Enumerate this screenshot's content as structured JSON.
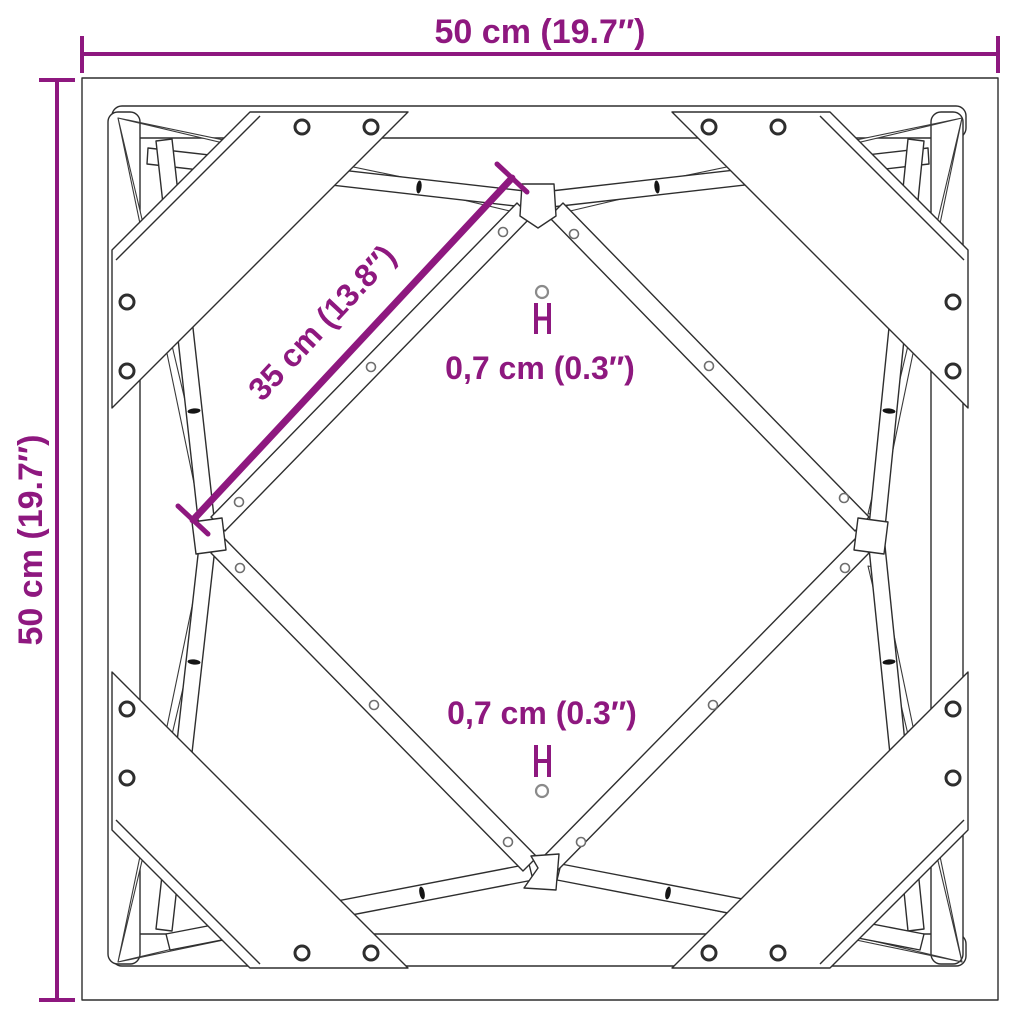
{
  "diagram": {
    "colors": {
      "dimension_accent": "#8E187F",
      "line_art": "#2e2e2e",
      "background": "#ffffff"
    },
    "labels": {
      "width": "50 cm (19.7″)",
      "height": "50 cm (19.7″)",
      "brace": "35 cm (13.8″)",
      "hole_top": "0,7 cm (0.3″)",
      "hole_bottom": "0,7 cm (0.3″)"
    }
  }
}
